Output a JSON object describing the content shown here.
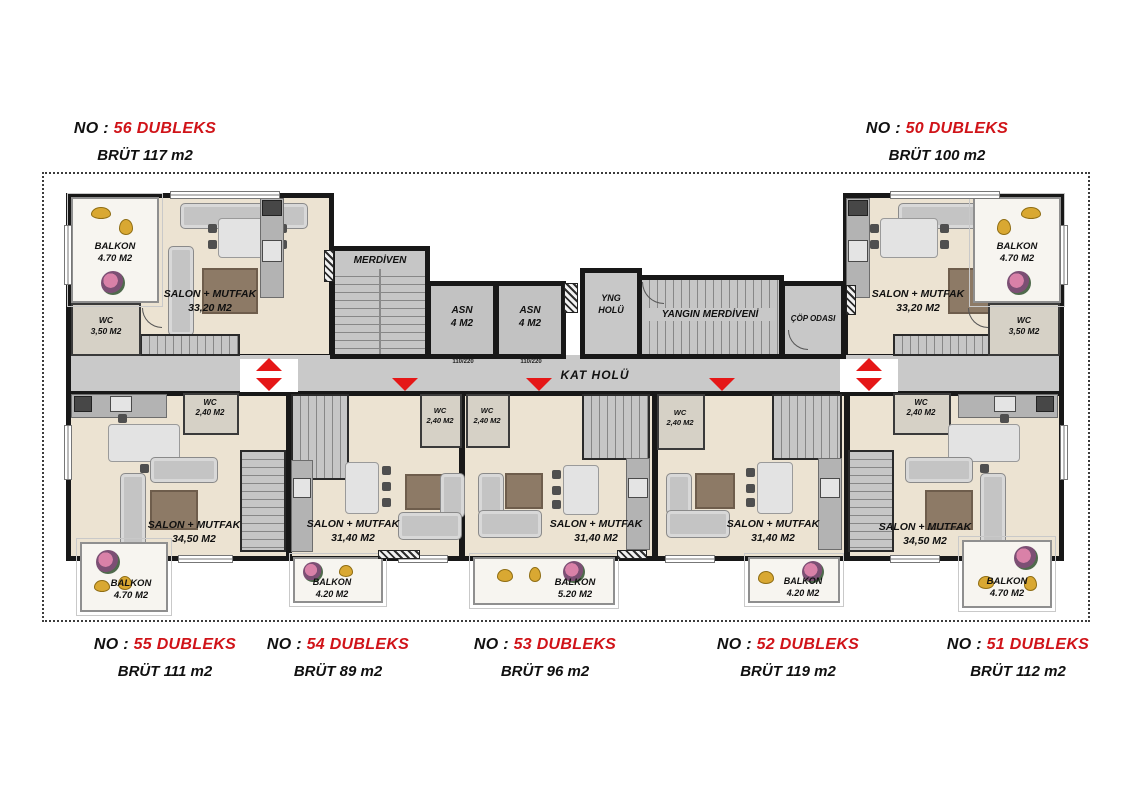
{
  "units": {
    "u56": {
      "no": "NO : ",
      "num": "56 DUBLEKS",
      "brut": "BRÜT 117 m2"
    },
    "u50": {
      "no": "NO : ",
      "num": "50 DUBLEKS",
      "brut": "BRÜT 100 m2"
    },
    "u55": {
      "no": "NO : ",
      "num": "55 DUBLEKS",
      "brut": "BRÜT 111 m2"
    },
    "u54": {
      "no": "NO : ",
      "num": "54 DUBLEKS",
      "brut": "BRÜT 89 m2"
    },
    "u53": {
      "no": "NO : ",
      "num": "53 DUBLEKS",
      "brut": "BRÜT 96 m2"
    },
    "u52": {
      "no": "NO : ",
      "num": "52 DUBLEKS",
      "brut": "BRÜT 119 m2"
    },
    "u51": {
      "no": "NO : ",
      "num": "51 DUBLEKS",
      "brut": "BRÜT 112 m2"
    }
  },
  "core": {
    "merdiven": "MERDİVEN",
    "asn": "ASN",
    "asn_area": "4 M2",
    "yng1": "YNG",
    "yng2": "HOLÜ",
    "yangin": "YANGIN MERDİVENİ",
    "cop": "ÇÖP ODASI",
    "kat_holu": "KAT HOLÜ",
    "dim": "110/220"
  },
  "rooms": {
    "salon56": {
      "name": "SALON + MUTFAK",
      "area": "33,20 M2"
    },
    "wc56": {
      "name": "WC",
      "area": "3,50 M2"
    },
    "balkon56": {
      "name": "BALKON",
      "area": "4.70 M2"
    },
    "salon50": {
      "name": "SALON + MUTFAK",
      "area": "33,20 M2"
    },
    "wc50": {
      "name": "WC",
      "area": "3,50 M2"
    },
    "balkon50": {
      "name": "BALKON",
      "area": "4.70 M2"
    },
    "salon55": {
      "name": "SALON + MUTFAK",
      "area": "34,50 M2"
    },
    "wc55": {
      "name": "WC",
      "area": "2,40 M2"
    },
    "balkon55": {
      "name": "BALKON",
      "area": "4.70 M2"
    },
    "salon54": {
      "name": "SALON + MUTFAK",
      "area": "31,40 M2"
    },
    "wc54": {
      "name": "WC",
      "area": "2,40 M2"
    },
    "balkon54": {
      "name": "BALKON",
      "area": "4.20 M2"
    },
    "salon53": {
      "name": "SALON + MUTFAK",
      "area": "31,40 M2"
    },
    "wc53": {
      "name": "WC",
      "area": "2,40 M2"
    },
    "balkon53": {
      "name": "BALKON",
      "area": "5.20 M2"
    },
    "salon52": {
      "name": "SALON + MUTFAK",
      "area": "31,40 M2"
    },
    "wc52": {
      "name": "WC",
      "area": "2,40 M2"
    },
    "balkon52": {
      "name": "BALKON",
      "area": "4.20 M2"
    },
    "salon51": {
      "name": "SALON + MUTFAK",
      "area": "34,50 M2"
    },
    "wc51": {
      "name": "WC",
      "area": "2,40 M2"
    },
    "balkon51": {
      "name": "BALKON",
      "area": "4.70 M2"
    }
  },
  "colors": {
    "accent_red": "#d01318",
    "wall": "#181818",
    "floor": "#ece3d2",
    "hall": "#c9c9c9"
  }
}
